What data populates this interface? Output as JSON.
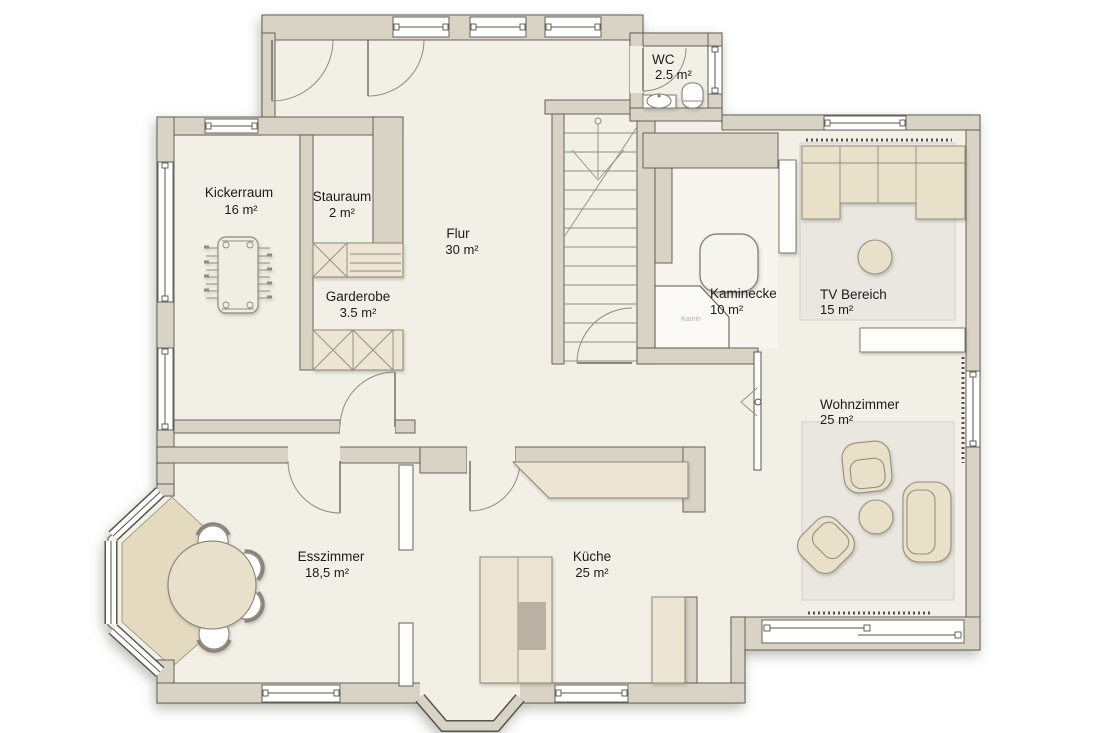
{
  "plan": {
    "rooms": [
      {
        "key": "kickerraum",
        "name": "Kickerraum",
        "area": "16 m²"
      },
      {
        "key": "stauraum",
        "name": "Stauraum",
        "area": "2 m²"
      },
      {
        "key": "flur",
        "name": "Flur",
        "area": "30 m²"
      },
      {
        "key": "garderobe",
        "name": "Garderobe",
        "area": "3.5 m²"
      },
      {
        "key": "wc",
        "name": "WC",
        "area": "2.5 m²"
      },
      {
        "key": "kaminecke",
        "name": "Kaminecke",
        "area": "10 m²"
      },
      {
        "key": "tv_bereich",
        "name": "TV Bereich",
        "area": "15 m²"
      },
      {
        "key": "wohnzimmer",
        "name": "Wohnzimmer",
        "area": "25 m²"
      },
      {
        "key": "esszimmer",
        "name": "Esszimmer",
        "area": "18,5 m²"
      },
      {
        "key": "kueche",
        "name": "Küche",
        "area": "25 m²"
      }
    ],
    "labels": {
      "kamin": "Kamin"
    },
    "colors": {
      "wall": "#d9d3c6",
      "floor": "#f2efe6",
      "outline": "#56544c",
      "furniture_beige": "#e8e0c8",
      "counter": "#ece5d3",
      "rug": "#e9e7e0",
      "bay_floor": "#e3dabf",
      "cooktop": "#b9b2a4",
      "white_fixture": "#fdfdfb"
    }
  }
}
